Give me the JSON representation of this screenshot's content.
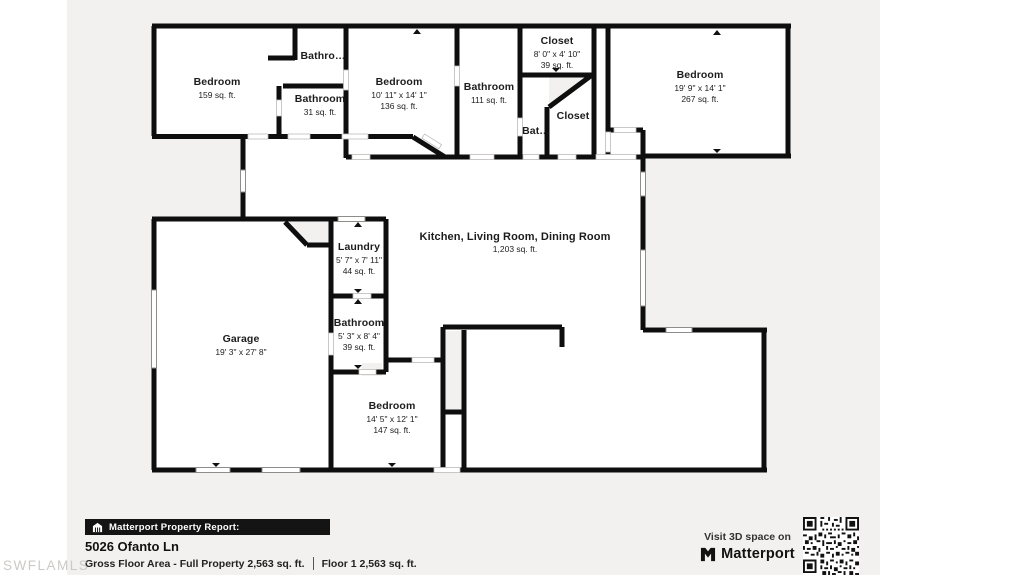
{
  "watermark": "SWFLAMLS",
  "floorplan": {
    "rooms": [
      {
        "name": "Bedroom",
        "area": "159 sq. ft."
      },
      {
        "name": "Bathro…"
      },
      {
        "name": "Bathroom",
        "area": "31 sq. ft."
      },
      {
        "name": "Bedroom",
        "dims": "10' 11\" x 14' 1\"",
        "area": "136 sq. ft."
      },
      {
        "name": "Bathroom",
        "area": "111 sq. ft."
      },
      {
        "name": "Closet",
        "dims": "8' 0\" x 4' 10\"",
        "area": "39 sq. ft."
      },
      {
        "name": "Bat…"
      },
      {
        "name": "Closet"
      },
      {
        "name": "Bedroom",
        "dims": "19' 9\" x 14' 1\"",
        "area": "267 sq. ft."
      },
      {
        "name": "Kitchen, Living Room, Dining Room",
        "area": "1,203 sq. ft."
      },
      {
        "name": "Laundry",
        "dims": "5' 7\" x 7' 11\"",
        "area": "44 sq. ft."
      },
      {
        "name": "Garage",
        "dims": "19' 3\" x 27' 8\""
      },
      {
        "name": "Bathroom",
        "dims": "5' 3\" x 8' 4\"",
        "area": "39 sq. ft."
      },
      {
        "name": "Bedroom",
        "dims": "14' 5\" x 12' 1\"",
        "area": "147 sq. ft."
      }
    ]
  },
  "footer": {
    "report_label": "Matterport Property Report:",
    "address": "5026 Ofanto Ln",
    "gross_floor_area": "Gross Floor Area - Full Property 2,563 sq. ft.",
    "floor_area": "Floor 1 2,563 sq. ft.",
    "visit_text": "Visit 3D space on",
    "brand": "Matterport"
  },
  "colors": {
    "canvas": "#f2f1ef",
    "wall": "#0e0e0e",
    "accent_bar": "#141414"
  }
}
